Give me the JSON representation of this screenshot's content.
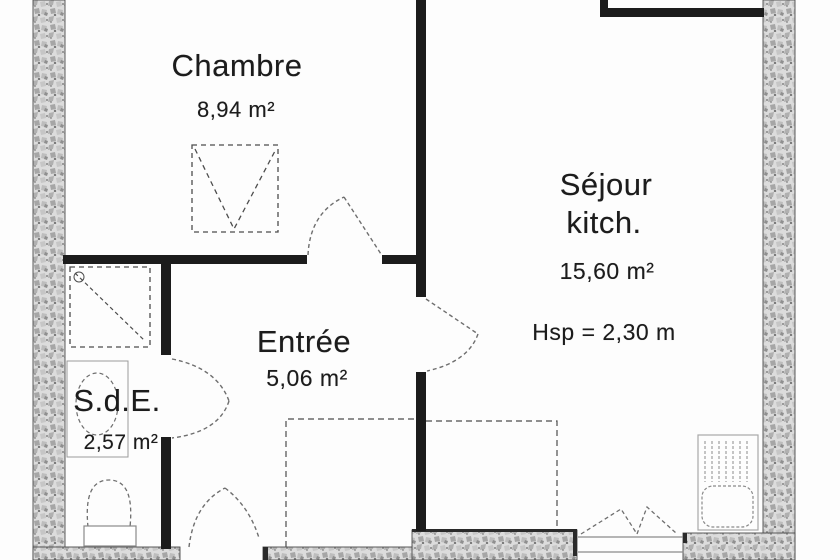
{
  "floor_plan": {
    "rooms": {
      "chambre": {
        "name": "Chambre",
        "area": "8,94 m²"
      },
      "sejour": {
        "name": "Séjour",
        "subname": "kitch.",
        "area": "15,60 m²",
        "ceiling_height": "Hsp = 2,30 m"
      },
      "entree": {
        "name": "Entrée",
        "area": "5,06 m²"
      },
      "sde": {
        "name": "S.d.E.",
        "area": "2,57 m²"
      }
    },
    "colors": {
      "wall_black": "#1c1c1c",
      "wall_hatch_base": "#dcdcdc",
      "symbol_gray": "#6e6e6e"
    }
  }
}
